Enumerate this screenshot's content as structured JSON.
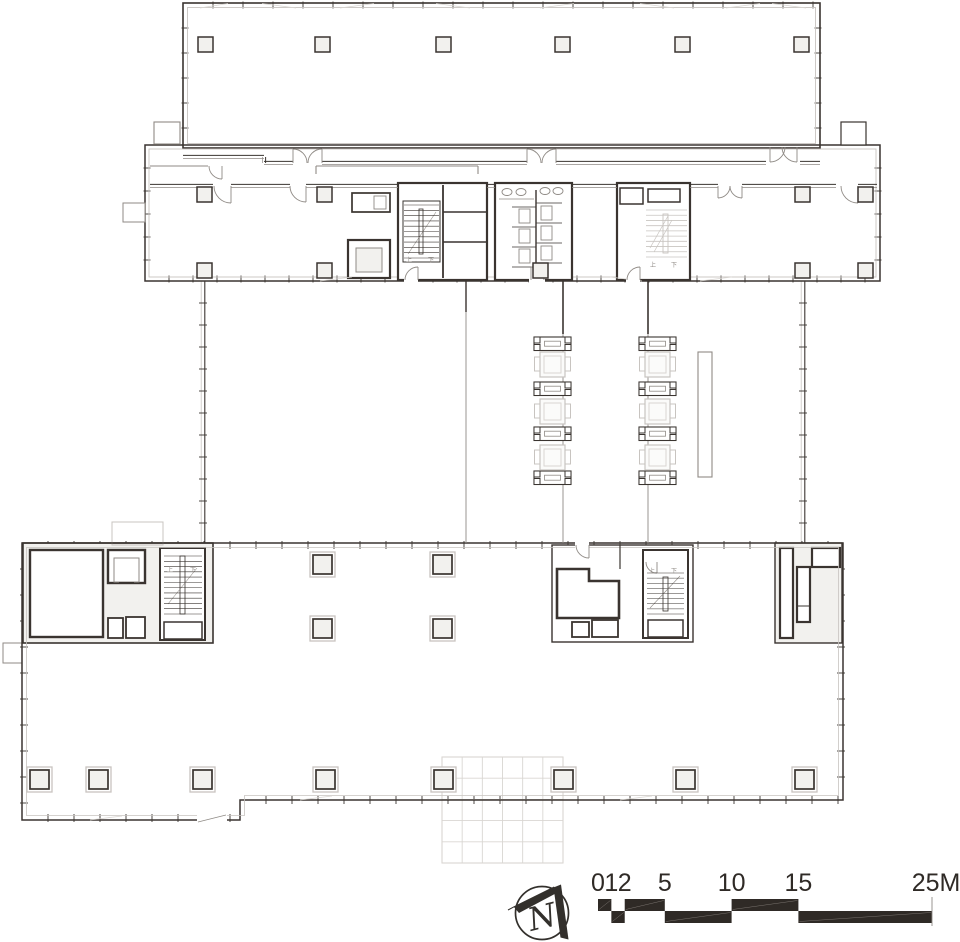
{
  "page": {
    "background": "#ffffff",
    "kind_label": "architectural floor plan"
  },
  "plan": {
    "view": {
      "w": 960,
      "h": 942
    },
    "styles": {
      "ink": "#3a3430",
      "mid": "#8f8a85",
      "light": "#c8c4c0",
      "faint": "#d9d6d2",
      "fill": "#f2f1ee",
      "paper": "#ffffff"
    },
    "tickwalls": [
      [
        183,
        5,
        820,
        5,
        30,
        7,
        0
      ],
      [
        185,
        3,
        185,
        148,
        25,
        7,
        0
      ],
      [
        818,
        3,
        818,
        148,
        25,
        7,
        0
      ],
      [
        147,
        145,
        147,
        281,
        23,
        7,
        0
      ],
      [
        878,
        145,
        878,
        281,
        23,
        7,
        0
      ],
      [
        145,
        279,
        880,
        279,
        24,
        7,
        0
      ],
      [
        203,
        281,
        203,
        543,
        22,
        8,
        1
      ],
      [
        803,
        281,
        803,
        543,
        22,
        8,
        1
      ],
      [
        22,
        545,
        843,
        545,
        26,
        8,
        0
      ],
      [
        24,
        543,
        24,
        820,
        26,
        8,
        0
      ],
      [
        22,
        818,
        240,
        818,
        26,
        8,
        0
      ],
      [
        240,
        800,
        843,
        800,
        26,
        8,
        0
      ],
      [
        841,
        543,
        841,
        800,
        26,
        8,
        0
      ]
    ],
    "canopy": {
      "x": 442,
      "y": 757,
      "w": 121,
      "h": 106,
      "cols": 6,
      "rows": 5
    },
    "rects": [
      [
        23,
        543,
        190,
        100,
        "ink",
        1.6,
        "fill"
      ],
      [
        775,
        543,
        67,
        100,
        "ink",
        1.4,
        "fill"
      ],
      [
        183,
        3,
        637,
        145,
        "ink",
        1.6,
        "none"
      ],
      [
        187.5,
        7.5,
        628,
        136,
        "light",
        0.9,
        "none"
      ],
      [
        145,
        145,
        735,
        136,
        "ink",
        1.5,
        "none"
      ],
      [
        149,
        149,
        727,
        128,
        "light",
        0.9,
        "none"
      ],
      [
        154,
        122,
        26,
        22,
        "mid",
        1.1,
        "paper"
      ],
      [
        841,
        122,
        25,
        23,
        "ink",
        1.2,
        "paper"
      ],
      [
        123,
        203,
        22,
        19,
        "mid",
        1.0,
        "paper"
      ],
      [
        112,
        522,
        51,
        23,
        "light",
        1.0,
        "none"
      ],
      [
        3,
        643,
        19,
        20,
        "mid",
        1.0,
        "none"
      ],
      [
        398,
        183,
        89,
        97,
        "ink",
        2.2,
        "paper"
      ],
      [
        495,
        183,
        77,
        97,
        "ink",
        2.2,
        "paper"
      ],
      [
        617,
        183,
        73,
        97,
        "ink",
        2.2,
        "paper"
      ],
      [
        403,
        201,
        37,
        61,
        "ink",
        1.0,
        "none"
      ],
      [
        352,
        193,
        38,
        19,
        "ink",
        1.7,
        "paper"
      ],
      [
        374,
        196,
        12,
        13,
        "mid",
        0.9,
        "none"
      ],
      [
        348,
        240,
        42,
        38,
        "ink",
        2.2,
        "paper"
      ],
      [
        356,
        248,
        26,
        24,
        "mid",
        1.0,
        "fill"
      ],
      [
        419,
        209,
        4,
        45,
        "ink",
        0.8,
        "paper"
      ],
      [
        519,
        209,
        11,
        14,
        "mid",
        0.9,
        "none"
      ],
      [
        519,
        229,
        11,
        14,
        "mid",
        0.9,
        "none"
      ],
      [
        519,
        249,
        11,
        14,
        "mid",
        0.9,
        "none"
      ],
      [
        541,
        206,
        11,
        14,
        "mid",
        0.9,
        "none"
      ],
      [
        541,
        226,
        11,
        14,
        "mid",
        0.9,
        "none"
      ],
      [
        541,
        246,
        11,
        14,
        "mid",
        0.9,
        "none"
      ],
      [
        620,
        188,
        23,
        16,
        "ink",
        1.5,
        "paper"
      ],
      [
        648,
        189,
        32,
        13,
        "ink",
        1.5,
        "paper"
      ],
      [
        663,
        214,
        5,
        39,
        "light",
        0.9,
        "paper"
      ],
      [
        30,
        550,
        73,
        87,
        "ink",
        2.4,
        "paper"
      ],
      [
        108,
        550,
        37,
        33,
        "ink",
        2.4,
        "paper"
      ],
      [
        114,
        558,
        25,
        24,
        "mid",
        1.0,
        "none"
      ],
      [
        108,
        618,
        15,
        20,
        "ink",
        1.8,
        "paper"
      ],
      [
        126,
        617,
        19,
        21,
        "ink",
        1.8,
        "paper"
      ],
      [
        160,
        548,
        45,
        92,
        "ink",
        2.0,
        "paper"
      ],
      [
        164,
        622,
        38,
        17,
        "ink",
        1.5,
        "none"
      ],
      [
        180,
        556,
        5,
        58,
        "ink",
        0.8,
        "paper"
      ],
      [
        552,
        545,
        141,
        97,
        "ink",
        1.4,
        "paper"
      ],
      [
        572,
        622,
        17,
        15,
        "ink",
        1.8,
        "paper"
      ],
      [
        592,
        620,
        26,
        17,
        "ink",
        1.8,
        "paper"
      ],
      [
        643,
        550,
        45,
        88,
        "ink",
        2.0,
        "paper"
      ],
      [
        648,
        620,
        35,
        17,
        "ink",
        1.5,
        "none"
      ],
      [
        663,
        577,
        5,
        34,
        "ink",
        0.8,
        "paper"
      ],
      [
        780,
        548,
        13,
        90,
        "ink",
        2.2,
        "paper"
      ],
      [
        812,
        548,
        28,
        19,
        "ink",
        2.2,
        "paper"
      ],
      [
        797,
        567,
        13,
        55,
        "ink",
        2.2,
        "paper"
      ],
      [
        698,
        352,
        14,
        125,
        "mid",
        1.1,
        "none"
      ]
    ],
    "paths": [
      [
        "M22,543 L843,543 L843,800 L240,800 L240,820 L22,820 Z",
        "ink",
        1.5,
        "none"
      ],
      [
        "M26.5,547.5 L838.5,547.5 L838.5,795.5 L244.5,795.5 L244.5,815.5 L26.5,815.5 Z",
        "light",
        0.8,
        "none"
      ],
      [
        "M557,618 L557,569 L589,569 L589,581 L619,581 L619,618 Z",
        "ink",
        2.6,
        "paper"
      ]
    ],
    "lines": [
      [
        443,
        185,
        443,
        278,
        "ink",
        1.8
      ],
      [
        443,
        212,
        487,
        212,
        "ink",
        1.4
      ],
      [
        443,
        242,
        487,
        242,
        "ink",
        1.4
      ],
      [
        536,
        190,
        536,
        270,
        "ink",
        1.4
      ],
      [
        512,
        207,
        536,
        207,
        "ink",
        0.8
      ],
      [
        512,
        227,
        536,
        227,
        "ink",
        0.8
      ],
      [
        512,
        247,
        536,
        247,
        "ink",
        0.8
      ],
      [
        512,
        267,
        536,
        267,
        "ink",
        0.8
      ],
      [
        536,
        203,
        562,
        203,
        "ink",
        0.8
      ],
      [
        536,
        223,
        562,
        223,
        "ink",
        0.8
      ],
      [
        536,
        243,
        562,
        243,
        "ink",
        0.8
      ],
      [
        536,
        263,
        562,
        263,
        "ink",
        0.8
      ],
      [
        499,
        199,
        534,
        199,
        "mid",
        0.8
      ],
      [
        316,
        166,
        478,
        166,
        "mid",
        1.1
      ],
      [
        316,
        166,
        316,
        174,
        "mid",
        1.1
      ],
      [
        478,
        166,
        478,
        174,
        "mid",
        1.1
      ],
      [
        150,
        166,
        208,
        166,
        "mid",
        1.1
      ],
      [
        466,
        281,
        466,
        543,
        "mid",
        0.9
      ],
      [
        563,
        281,
        563,
        543,
        "mid",
        0.9
      ],
      [
        648,
        281,
        648,
        543,
        "mid",
        0.9
      ],
      [
        466,
        281,
        466,
        312,
        "ink",
        1.4
      ],
      [
        563,
        281,
        563,
        334,
        "ink",
        1.6
      ],
      [
        648,
        281,
        648,
        334,
        "ink",
        1.6
      ],
      [
        620,
        545,
        620,
        569,
        "ink",
        1.2
      ],
      [
        119,
        583,
        134,
        583,
        "ink",
        2.0
      ],
      [
        797,
        606,
        810,
        606,
        "ink",
        1.0
      ],
      [
        408,
        254,
        436,
        212,
        "mid",
        0.55
      ],
      [
        168,
        604,
        197,
        568,
        "mid",
        0.55
      ],
      [
        650,
        608,
        680,
        576,
        "mid",
        0.55
      ],
      [
        650,
        248,
        668,
        216,
        "light",
        0.7
      ],
      [
        654,
        252,
        672,
        220,
        "light",
        0.7
      ],
      [
        200,
        8,
        228,
        3.5,
        "faint",
        0.8
      ],
      [
        262,
        3.5,
        296,
        8,
        "faint",
        0.8
      ],
      [
        340,
        8,
        374,
        3.5,
        "faint",
        0.8
      ],
      [
        436,
        3.5,
        470,
        8,
        "faint",
        0.8
      ],
      [
        540,
        8,
        574,
        3.5,
        "faint",
        0.8
      ],
      [
        640,
        3.5,
        674,
        8,
        "faint",
        0.8
      ],
      [
        726,
        8,
        760,
        3.5,
        "faint",
        0.8
      ],
      [
        772,
        3.5,
        806,
        8,
        "faint",
        0.8
      ],
      [
        320,
        281,
        352,
        277,
        "faint",
        0.8
      ],
      [
        610,
        277,
        642,
        281,
        "faint",
        0.8
      ],
      [
        700,
        281,
        732,
        277,
        "faint",
        0.8
      ],
      [
        300,
        800,
        332,
        796,
        "faint",
        0.8
      ],
      [
        620,
        800,
        652,
        796,
        "faint",
        0.8
      ],
      [
        90,
        820,
        122,
        816,
        "faint",
        0.8
      ]
    ],
    "dwalls": [
      [
        150,
        186,
        213,
        186
      ],
      [
        231,
        186,
        290,
        186
      ],
      [
        306,
        186,
        398,
        186
      ],
      [
        487,
        186,
        495,
        186
      ],
      [
        572,
        186,
        617,
        186
      ],
      [
        690,
        186,
        718,
        186
      ],
      [
        742,
        186,
        836,
        186
      ],
      [
        858,
        186,
        877,
        186
      ],
      [
        183,
        157,
        264,
        157
      ],
      [
        264,
        157,
        264,
        163
      ],
      [
        264,
        163,
        293,
        163
      ],
      [
        322,
        163,
        527,
        163
      ],
      [
        556,
        163,
        766,
        163
      ],
      [
        800,
        163,
        820,
        163
      ]
    ],
    "gaps": [
      [
        404,
        277,
        14,
        7
      ],
      [
        529,
        277,
        16,
        7
      ],
      [
        626,
        277,
        14,
        7
      ],
      [
        575,
        542,
        14,
        7
      ],
      [
        197,
        814,
        30,
        10
      ]
    ],
    "lines2": [
      [
        198,
        822,
        226,
        815,
        "mid",
        0.8
      ]
    ],
    "arcs": [
      [
        293,
        163,
        14,
        270,
        360,
        270
      ],
      [
        322,
        163,
        14,
        180,
        270,
        270
      ],
      [
        527,
        163,
        14,
        270,
        360,
        270
      ],
      [
        556,
        163,
        14,
        180,
        270,
        270
      ],
      [
        770,
        147,
        15,
        0,
        90,
        90
      ],
      [
        797,
        147,
        15,
        90,
        180,
        90
      ],
      [
        231,
        186,
        17,
        90,
        180,
        90
      ],
      [
        306,
        186,
        16,
        90,
        180,
        90
      ],
      [
        718,
        186,
        12,
        0,
        90,
        90
      ],
      [
        742,
        186,
        12,
        90,
        180,
        90
      ],
      [
        858,
        186,
        17,
        90,
        180,
        90
      ],
      [
        222,
        166,
        13,
        90,
        180,
        90
      ],
      [
        418,
        280,
        13,
        180,
        270,
        270
      ],
      [
        531,
        280,
        13,
        270,
        360,
        270
      ],
      [
        640,
        280,
        13,
        180,
        270,
        270
      ],
      [
        589,
        545,
        13,
        90,
        180,
        90
      ],
      [
        657,
        562,
        11,
        90,
        180,
        90
      ]
    ],
    "stairs": [
      [
        404,
        205,
        35,
        53,
        11,
        "ink",
        0.6
      ],
      [
        646,
        210,
        41,
        47,
        10,
        "light",
        0.8
      ],
      [
        164,
        556,
        38,
        58,
        12,
        "ink",
        0.6
      ],
      [
        647,
        573,
        37,
        41,
        9,
        "ink",
        0.6
      ]
    ],
    "ellipses": [
      [
        507,
        192,
        5,
        3.5
      ],
      [
        521,
        192,
        5,
        3.5
      ],
      [
        545,
        191,
        5,
        3.5
      ],
      [
        558,
        191,
        5,
        3.5
      ]
    ],
    "columns_small": {
      "size": 15,
      "items": [
        [
          198,
          37
        ],
        [
          315,
          37
        ],
        [
          436,
          37
        ],
        [
          555,
          37
        ],
        [
          675,
          37
        ],
        [
          794,
          37
        ],
        [
          197,
          187
        ],
        [
          317,
          187
        ],
        [
          795,
          187
        ],
        [
          858,
          187
        ],
        [
          197,
          263
        ],
        [
          317,
          263
        ],
        [
          533,
          263
        ],
        [
          795,
          263
        ],
        [
          858,
          263
        ]
      ]
    },
    "columns_double": {
      "outer": 25,
      "inner": 19,
      "items": [
        [
          310,
          552
        ],
        [
          430,
          552
        ],
        [
          310,
          616
        ],
        [
          430,
          616
        ],
        [
          27,
          767
        ],
        [
          86,
          767
        ],
        [
          190,
          767
        ],
        [
          313,
          767
        ],
        [
          431,
          767
        ],
        [
          551,
          767
        ],
        [
          673,
          767
        ],
        [
          792,
          767
        ]
      ]
    },
    "furniture": {
      "cxs": [
        552.5,
        657.5
      ],
      "bench_y": [
        337,
        382,
        427,
        471
      ],
      "table_y": [
        352,
        399,
        445
      ]
    },
    "texts": [
      [
        "上",
        406,
        262,
        6
      ],
      [
        "下",
        428,
        262,
        6
      ],
      [
        "上",
        650,
        267,
        6
      ],
      [
        "下",
        671,
        267,
        6
      ],
      [
        "上",
        167,
        572,
        6
      ],
      [
        "下",
        190,
        572,
        6
      ],
      [
        "上",
        649,
        573,
        6
      ],
      [
        "下",
        671,
        573,
        6
      ]
    ]
  },
  "scale_bar": {
    "x0": 598,
    "per_m": 13.36,
    "label_baseline_y": 891,
    "label_font_size": 25,
    "bar_y": 899,
    "row_h": 12,
    "labels": [
      [
        "0",
        0
      ],
      [
        "1",
        1
      ],
      [
        "2",
        2
      ],
      [
        "5",
        5
      ],
      [
        "10",
        10
      ],
      [
        "15",
        15
      ],
      [
        "25M",
        25.3
      ]
    ],
    "top_segments": [
      [
        0,
        1
      ],
      [
        2,
        5
      ],
      [
        10,
        15
      ]
    ],
    "bottom_segments": [
      [
        1,
        2
      ],
      [
        5,
        10
      ],
      [
        15,
        25
      ]
    ],
    "end_m": 25,
    "bar_color": "#2f2a26",
    "label_color": "#2f2a26"
  },
  "north_arrow": {
    "letter": "N",
    "cx": 542,
    "cy": 913,
    "r": 26.5,
    "arm1": "513.5,906.5 554,886.5 557.5,892.5 519,913",
    "arm2": "553.5,887.5 561,884.5 568.5,939.5 560.5,937.5",
    "tail": [
      508,
      910,
      514,
      906.8
    ],
    "letter_x": 527,
    "letter_y": 928,
    "letter_size": 32,
    "letter_rotate": -14,
    "color": "#33302c"
  }
}
